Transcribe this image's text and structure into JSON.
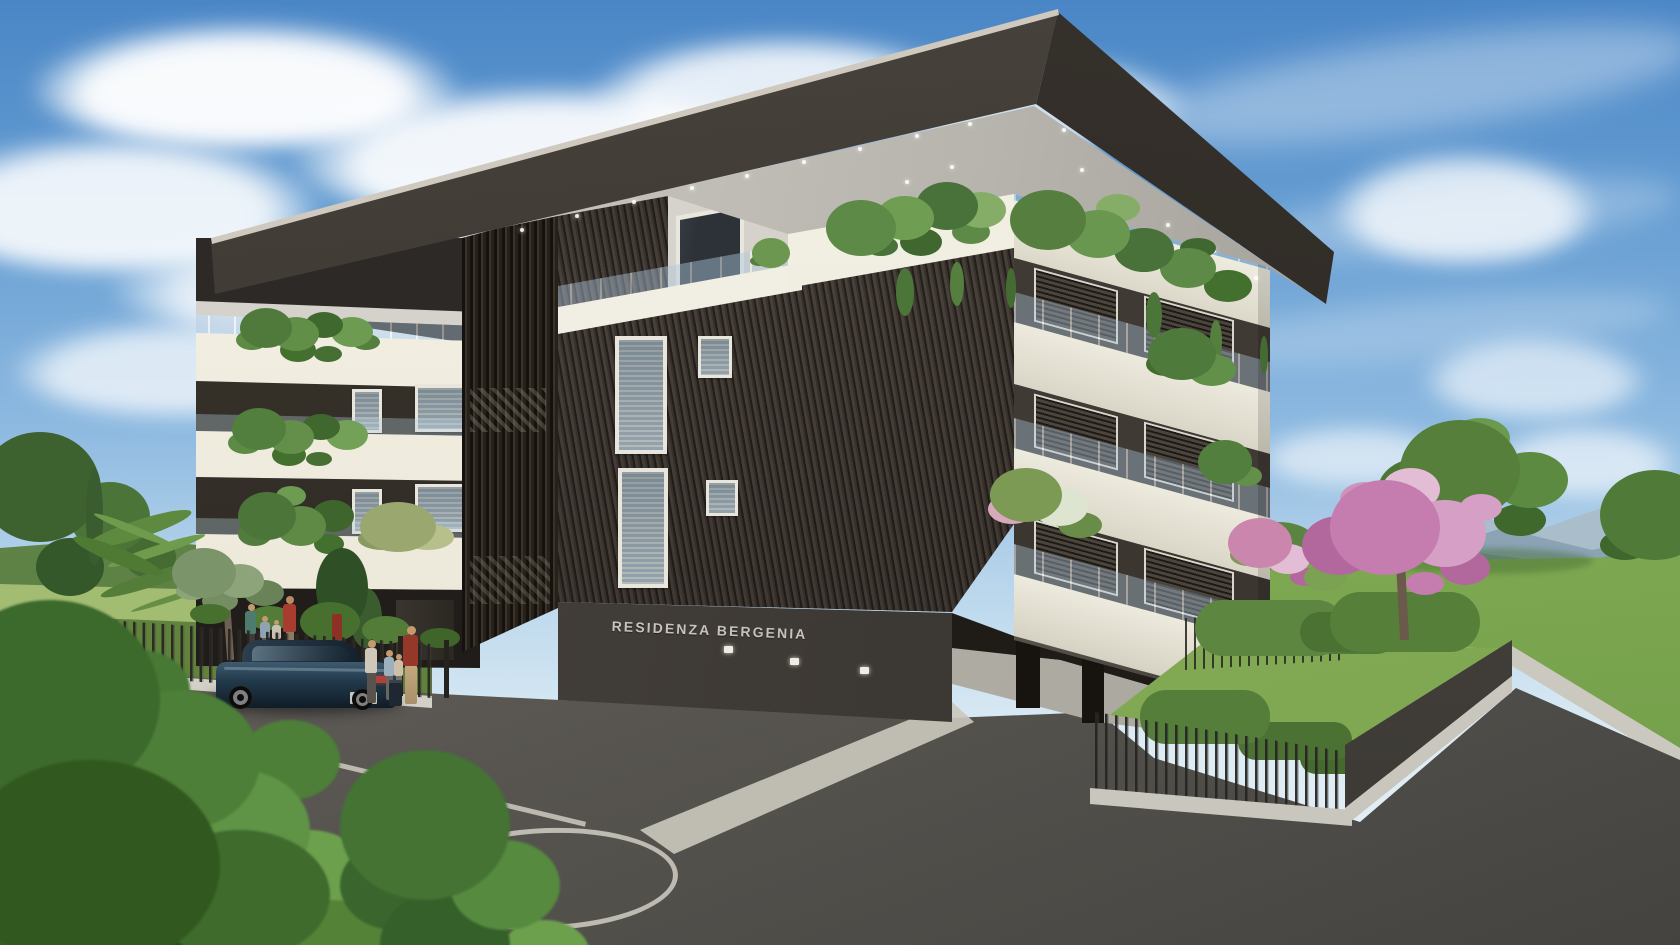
{
  "scene": {
    "title": "Residenza Bergenia — exterior architectural rendering",
    "type": "3D exterior visualization of a modern residential building",
    "building": {
      "sign": "RESIDENZA BERGENIA",
      "floors_visible": 4,
      "features": [
        "wrap-around white balconies",
        "glass balustrades",
        "balcony planters with trailing plants",
        "horizontal louvered facade",
        "vertical slatted stair tower",
        "deep roof overhang with recessed downlights",
        "dark base wall with building name sign",
        "three small facade lights",
        "ground-floor pillars and paved walkway"
      ],
      "facade_colors": {
        "roof_fascia": "#37322c",
        "balcony_bands": "#f4f1e6",
        "louvered_wall": "#3f3832",
        "stair_tower": "#2b2621",
        "base_wall": "#3f3b36",
        "soffit": "#c6c3bc"
      }
    },
    "foreground": {
      "parking": {
        "surface": "asphalt",
        "markings": [
          "diagonal parking stall lines",
          "white ellipse turning-area marking",
          "long edge line",
          "light concrete path strips"
        ],
        "marking_color": "#d2cec4"
      },
      "car": {
        "type": "dark sedan, rear three-quarter view",
        "color": "#22394b"
      },
      "people": {
        "at_gate": 4,
        "behind_fence": 4,
        "details": "family with child figures and luggage near entrance gate"
      },
      "fences": [
        "black vertical-bar perimeter fence on concrete curb",
        "solid dark fence panel at right garden corner"
      ],
      "vegetation": [
        "large foreground shrubs",
        "olive tree",
        "palm plants",
        "tall dark bush",
        "hedges",
        "pink flowering tree",
        "lawns",
        "balcony plants"
      ]
    },
    "background": {
      "sky": "blue sky with scattered cumulus clouds, wispy cirrus at right",
      "mountains": "hazy blue ridges on the right horizon",
      "left_horizon": "green fields with tree line"
    },
    "palette": {
      "sky_top": "#4a86c6",
      "sky_horizon": "#dcebf4",
      "cloud": "#f7fafc",
      "mountain": "#8ba3b5",
      "lawn": "#7fa84f",
      "asphalt": "#5d5955",
      "cream": "#f4f1e6",
      "dark_facade": "#37322c",
      "pink_tree": "#c98cb4",
      "fence": "#35332f",
      "car_body": "#22394b"
    }
  }
}
